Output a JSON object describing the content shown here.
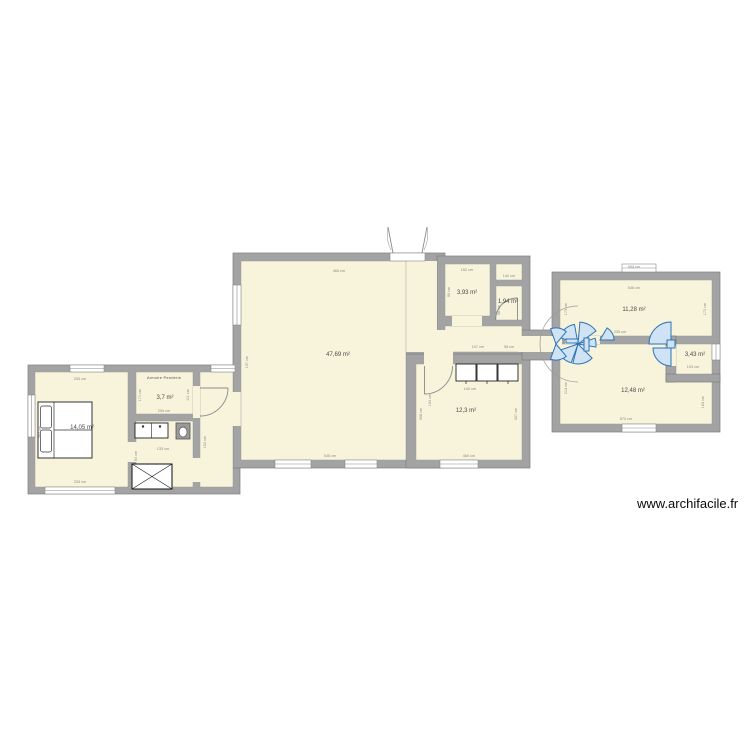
{
  "watermark": "www.archifacile.fr",
  "colors": {
    "wall": "#a3a3a3",
    "wall_edge": "#7d7d7d",
    "room_fill": "#f8f4dc",
    "door_blue": "#2e74b5",
    "door_blue_fill": "#cfe3f5",
    "dim_text": "#8a8a8a",
    "area_text": "#4a4a4a"
  },
  "rooms": [
    {
      "id": "living",
      "area": "47,69 m²"
    },
    {
      "id": "storage-top",
      "area": "3,93 m²"
    },
    {
      "id": "wc-top",
      "area": "1,94 m²"
    },
    {
      "id": "kitchen",
      "area": "12,3 m²"
    },
    {
      "id": "bedroom-right-top",
      "area": "11,28 m²"
    },
    {
      "id": "bedroom-right-bottom",
      "area": "12,48 m²"
    },
    {
      "id": "bathroom-right",
      "area": "3,43 m²"
    },
    {
      "id": "bedroom-left",
      "area": "14,05 m²"
    },
    {
      "id": "dressing",
      "area": "3,7 m²",
      "label": "Armoire Penderie"
    }
  ],
  "dims": [
    "465 cm",
    "545 cm",
    "197 cm",
    "104 cm",
    "152 cm",
    "90 cm",
    "140 cm",
    "58 cm",
    "107 cm",
    "98 cm",
    "460 cm",
    "308 cm",
    "307 cm",
    "140 cm",
    "546 cm",
    "173 cm",
    "172 cm",
    "235 cm",
    "570 cm",
    "213 cm",
    "163 cm",
    "103 cm",
    "594 cm",
    "253 cm",
    "253 cm",
    "364 cm",
    "171 cm",
    "111 cm",
    "206 cm",
    "133 cm",
    "94 cm",
    "152 cm"
  ]
}
